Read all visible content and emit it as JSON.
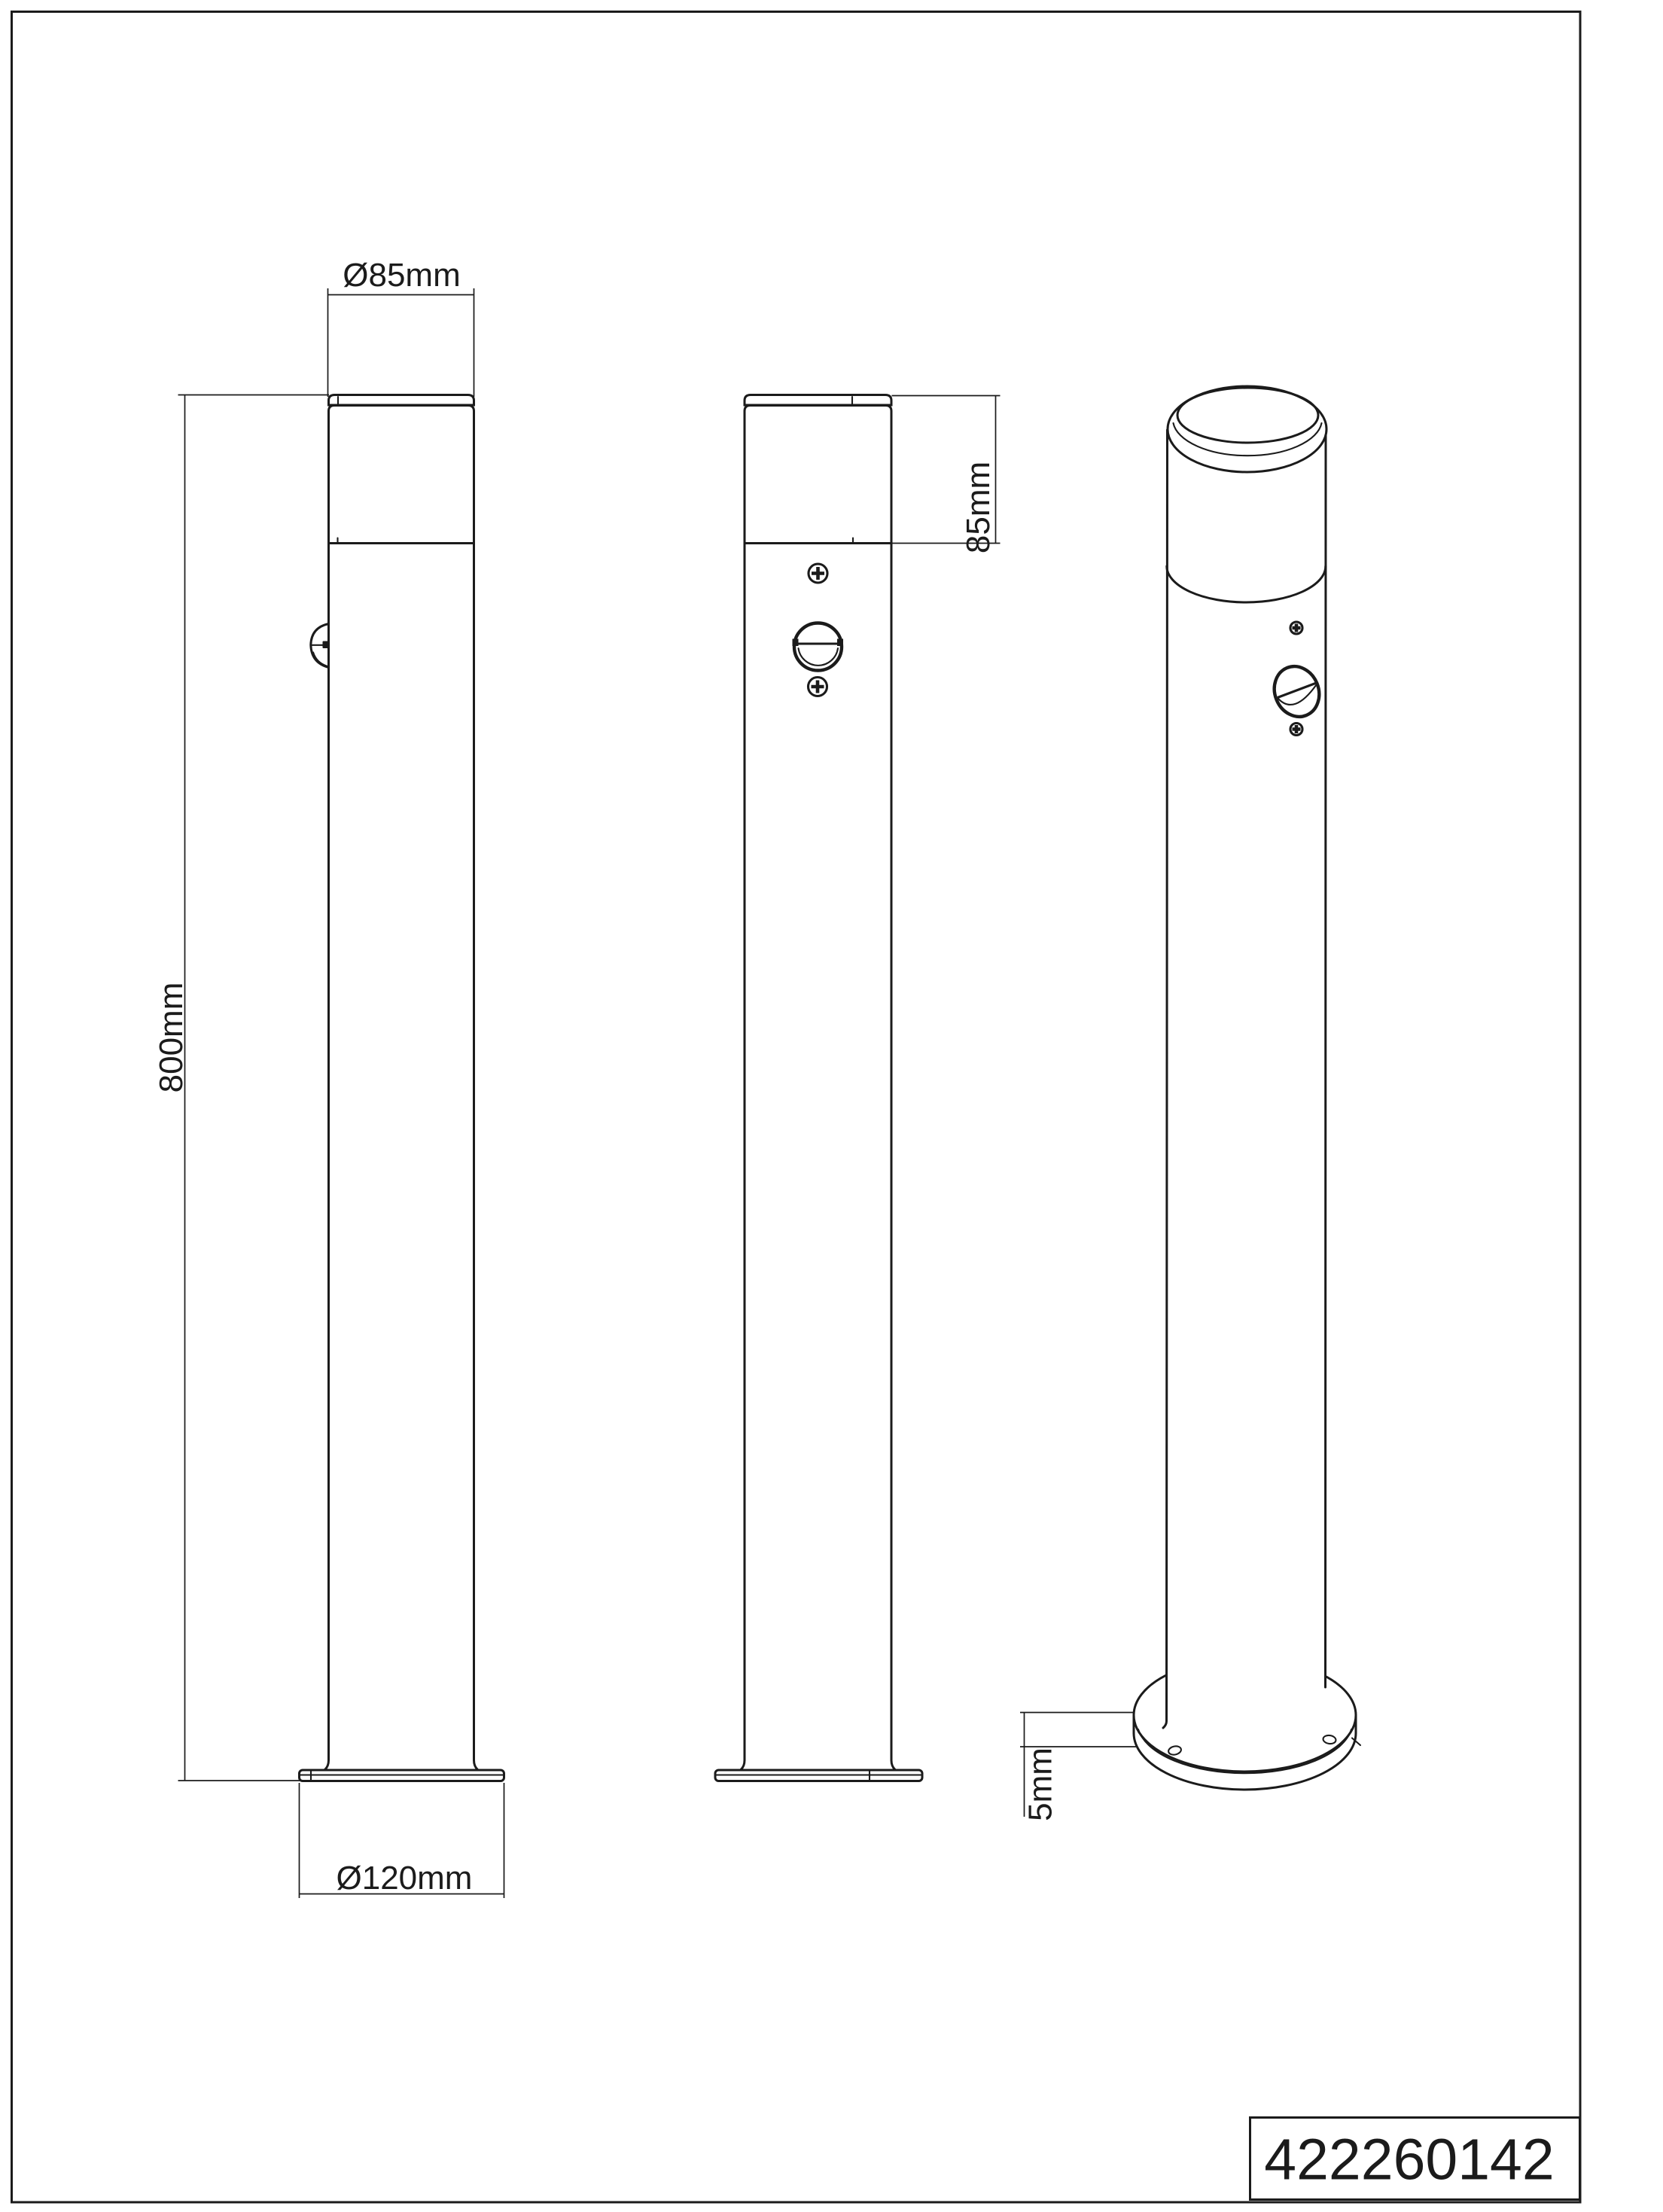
{
  "drawing": {
    "part_number": "422260142",
    "dimensions": {
      "top_diameter": "Ø85mm",
      "overall_height": "800mm",
      "head_height": "85mm",
      "base_diameter": "Ø120mm",
      "base_plate_thickness": "5mm"
    },
    "colors": {
      "line": "#1b1b1b",
      "background": "#ffffff"
    }
  }
}
